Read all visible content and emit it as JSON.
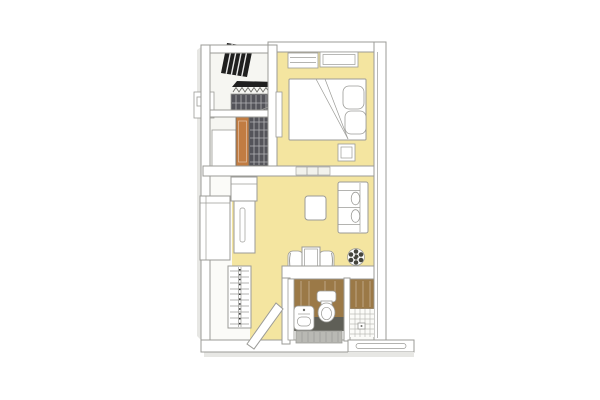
{
  "scene": {
    "type": "3d-floor-plan-rendering",
    "view": "axonometric cutaway of a studio apartment",
    "background": "#ffffff",
    "rooms": [
      {
        "name": "balcony",
        "floor": "light-gray",
        "items": [
          "hatched-drying-rack-panel",
          "hanger-rail",
          "slatted-cabinet",
          "ac-outdoor-unit"
        ]
      },
      {
        "name": "entry-hall",
        "floor": "light-gray",
        "items": [
          "front-door-brown",
          "shoe-cabinet",
          "dark-tiled-closet"
        ]
      },
      {
        "name": "bedroom",
        "floor": "yellow",
        "items": [
          "window-pair",
          "double-bed",
          "folded-blanket",
          "pillow-pair",
          "nightstand",
          "wall-door-leaf",
          "sliding-door-track"
        ]
      },
      {
        "name": "living-dining",
        "floor": "yellow",
        "items": [
          "kitchen-upper-cabinet",
          "kitchen-counter-with-sink",
          "exterior-storage-box",
          "ladder-shelf",
          "sofa-two-seat",
          "sofa-pillows",
          "coffee-table",
          "dining-table",
          "dining-chair-left",
          "dining-chair-right",
          "potted-plant",
          "open-door-leaf"
        ]
      },
      {
        "name": "bathroom",
        "walls": "wood-brown",
        "items": [
          "toilet",
          "washbasin",
          "dark-floor",
          "entry-step"
        ]
      },
      {
        "name": "shower-room",
        "walls": "wood-brown",
        "items": [
          "tiled-floor",
          "floor-drain"
        ]
      },
      {
        "name": "entrance",
        "items": [
          "entry-platform-with-slot"
        ]
      }
    ],
    "colors": {
      "wall": "#ffffff",
      "wallShade": "#e7e7e4",
      "floorBase": "#fbfbf8",
      "floorLight": "#f6f6f2",
      "floor": "#f4e5a0",
      "line": "#9b9b97",
      "lineDark": "#6e6e69",
      "panelDark": "#1f1f1f",
      "slat": "#54545a",
      "doorBrown": "#c17c42",
      "doorTrack": "#f2f2ed",
      "wood": "#9b7947",
      "bathFloor": "#5f5f57",
      "step": "#b9b9b4",
      "tileLine": "#bdbdb8",
      "plantDark": "#45453d"
    }
  }
}
